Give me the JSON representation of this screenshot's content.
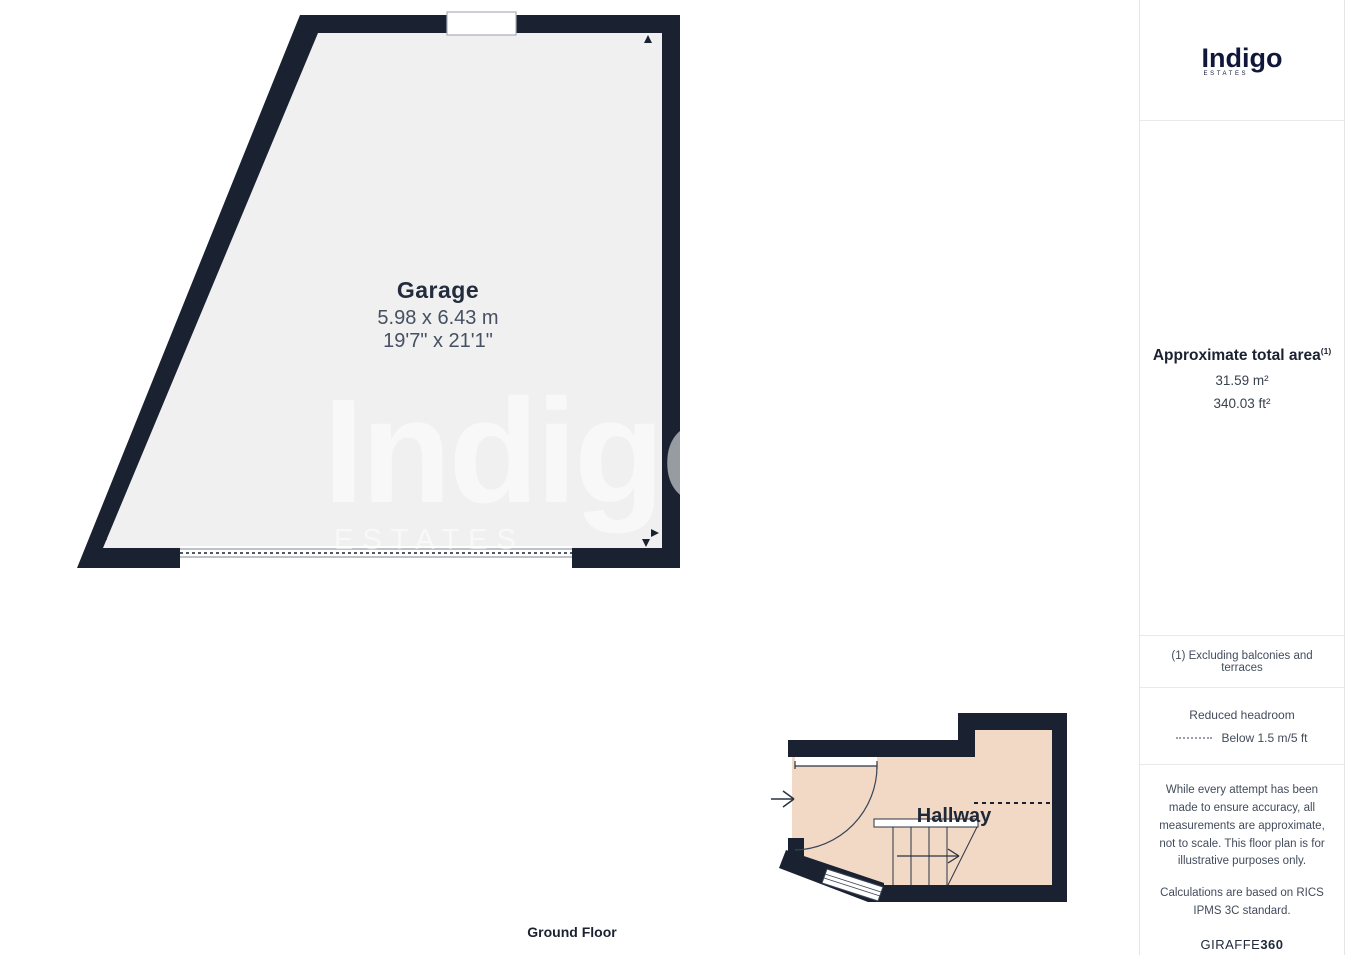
{
  "plan": {
    "floor_label": "Ground Floor",
    "garage": {
      "name": "Garage",
      "dim_metric": "5.98 x 6.43 m",
      "dim_imperial": "19'7\" x 21'1\""
    },
    "hallway": {
      "name": "Hallway"
    },
    "watermark": {
      "line1": "Indigo",
      "line2": "ESTATES"
    }
  },
  "sidebar": {
    "logo": {
      "name": "Indigo",
      "sub": "ESTATES"
    },
    "area": {
      "title": "Approximate total area",
      "footnote_marker": "(1)",
      "metric": "31.59 m²",
      "imperial": "340.03 ft²"
    },
    "footnote": "(1) Excluding balconies and terraces",
    "legend": {
      "title": "Reduced headroom",
      "item": "Below 1.5 m/5 ft"
    },
    "disclaimer": {
      "p1": "While every attempt has been made to ensure accuracy, all measurements are approximate, not to scale. This floor plan is for illustrative purposes only.",
      "p2": "Calculations are based on RICS IPMS 3C standard."
    },
    "brand": {
      "name": "GIRAFFE",
      "suffix": "360"
    }
  },
  "colors": {
    "wall": "#1a2231",
    "garage_floor": "#f0f0f1",
    "hallway_floor": "#f2d9c6",
    "line_gray": "#a9aeb6"
  }
}
